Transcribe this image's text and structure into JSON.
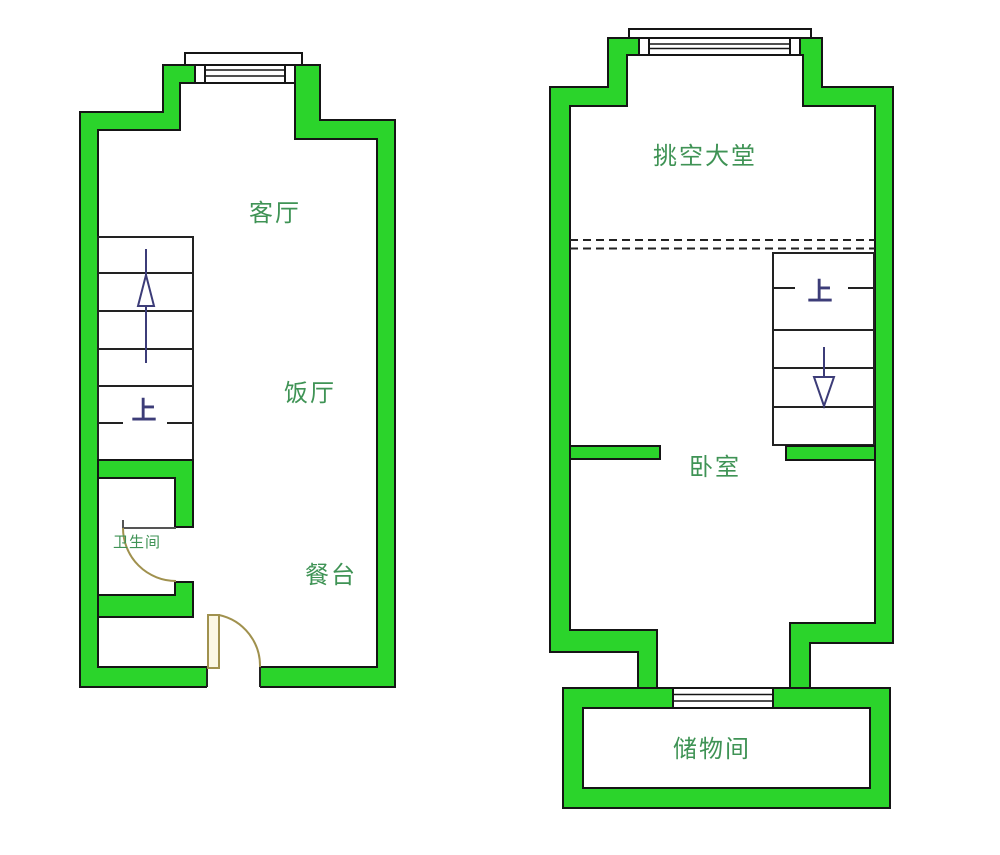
{
  "title": "duplex-floor-plan",
  "colors": {
    "wall": "#2bd42b",
    "outline": "#151515",
    "room_label": "#3f9355",
    "stair_label": "#3c3c78",
    "stair_line": "#222222",
    "door": "#a0914e",
    "door_panel": "#fbf7e3"
  },
  "floor_one": {
    "living_room": "客厅",
    "dining_room": "饭厅",
    "dining_counter": "餐台",
    "bathroom": "卫生间",
    "stairs_up": "上"
  },
  "floor_two": {
    "void_hall": "挑空大堂",
    "bedroom": "卧室",
    "storage_room": "储物间",
    "stairs_up": "上"
  }
}
